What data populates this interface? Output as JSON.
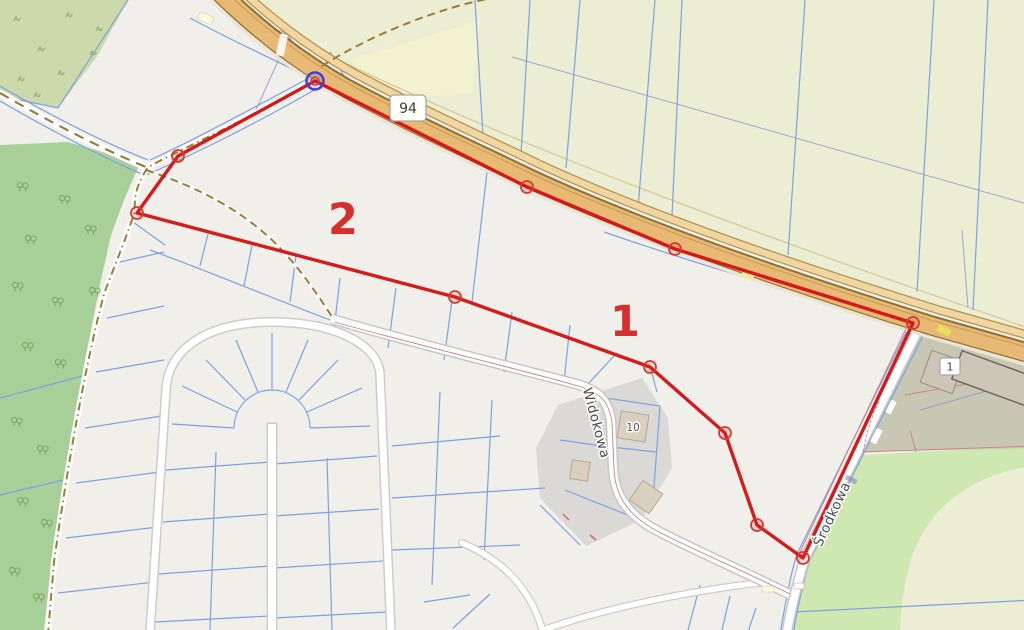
{
  "map": {
    "road_shield": {
      "ref": "94"
    },
    "street_labels": [
      {
        "name": "Widokowa"
      },
      {
        "name": "Środkowa"
      }
    ],
    "house_number": "10",
    "building_plate": "1",
    "area_markers": [
      {
        "id": "1"
      },
      {
        "id": "2"
      }
    ],
    "colors": {
      "selection_red": "#d41414",
      "vertex_ring": "#d43c2c",
      "active_vertex_blue": "#4040d8",
      "area_label_red": "#d62f2f",
      "farmland": "#ebeed2",
      "forest": "#a9cf99",
      "scrub": "#cbd9ab",
      "grass": "#cfe8b2",
      "brownfield": "#c7c7b3",
      "trunk_road": "#e8b975",
      "parcel_line": "#7da0e2",
      "track_brown": "#9b7d3a"
    }
  }
}
